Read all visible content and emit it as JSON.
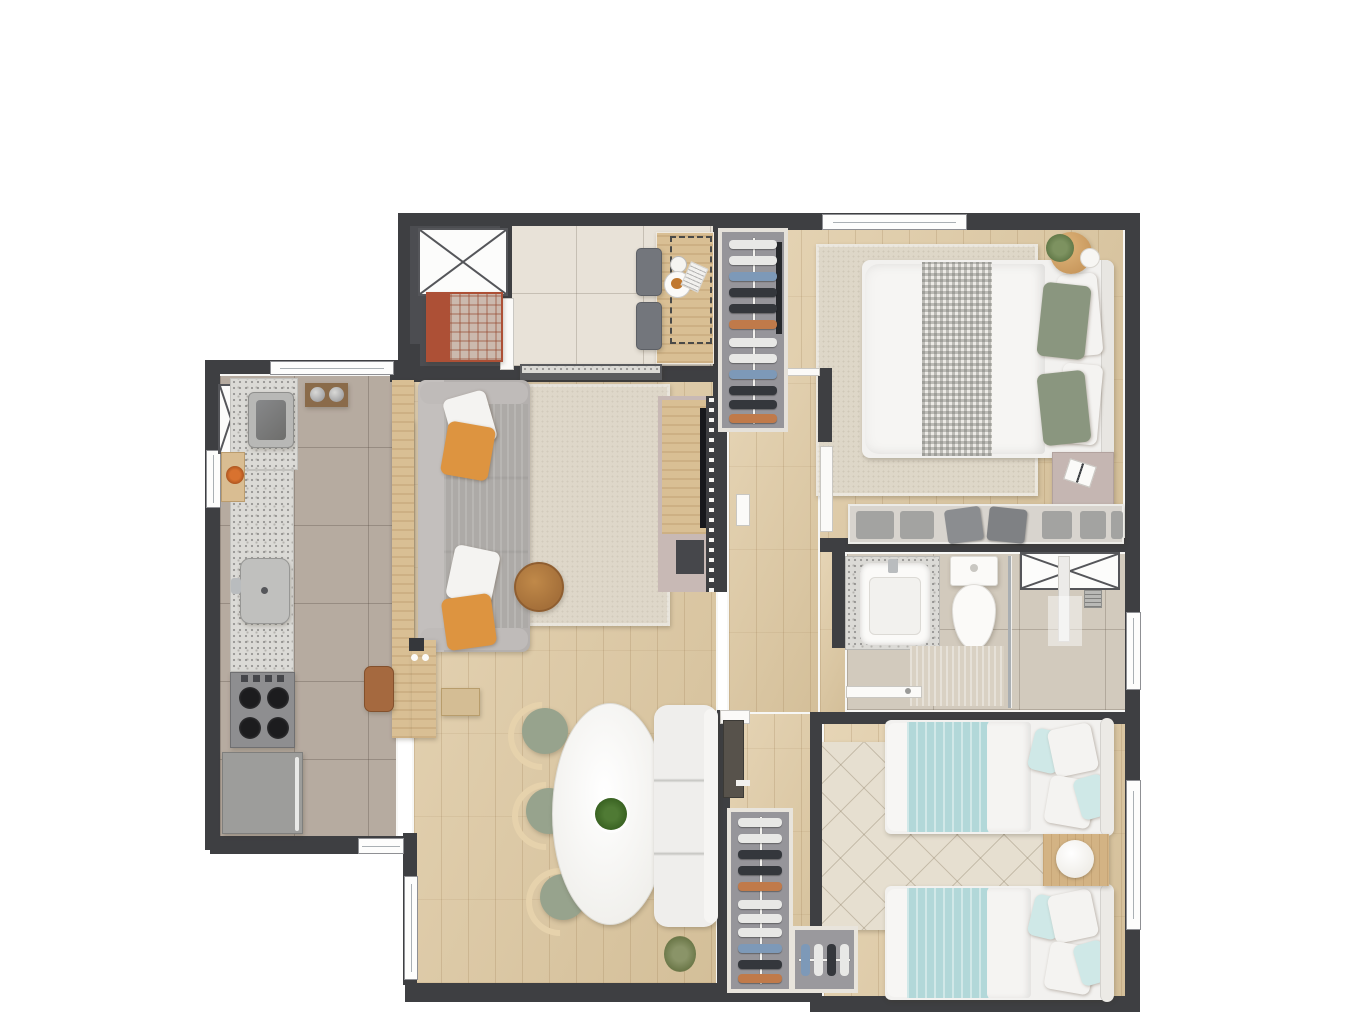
{
  "meta": {
    "title": "two-bedroom apartment floor plan (top-down 3D render)",
    "canvas": {
      "width": 1365,
      "height": 1024
    },
    "visible_text": "none"
  },
  "palette": {
    "background": "#ffffff",
    "wall": "#3e3f42",
    "wall_trim": "#f7f7f5",
    "wood_floor": "#dfc9a1",
    "entry_tile": "#e8e2d8",
    "kitchen_tile": "#b6aba0",
    "bath_tile": "#d2cabd",
    "granite": "#dbdad6",
    "sofa_gray": "#b4b0ae",
    "accent_orange": "#dd9440",
    "pillow_green": "#8a967f",
    "aqua_blanket": "#b2d8d9",
    "rug_cream": "#ded7c9",
    "rug_red": "#ad5036",
    "closet_gray": "#96959a",
    "furniture_wood": "#d9bf94",
    "dark_appliance": "#8e8e90"
  },
  "rooms": {
    "entry_hall": {
      "label": "hall and entry foyer",
      "items": [
        "elevator shaft",
        "red doormat rug with plaid throw",
        "console table",
        "dashed optional-furniture outline",
        "two gray side chairs",
        "breakfast tray with coffee and croissant"
      ]
    },
    "living_room": {
      "label": "living room",
      "items": [
        "gray chaise sofa",
        "orange and white throw pillows",
        "wood console with knobs",
        "round wood coffee table",
        "beige area rug",
        "TV wall panel with speaker",
        "granite-top sideboard",
        "slatted divider panel"
      ]
    },
    "kitchen": {
      "label": "kitchen and laundry",
      "items": [
        "laundry tank sink",
        "granite countertop",
        "stainless kitchen sink",
        "four-burner cooktop",
        "refrigerator",
        "breakfast bar peninsula",
        "bar stool",
        "duct shaft",
        "wall taps",
        "cutting board with flowers"
      ]
    },
    "dining_room": {
      "label": "dining area",
      "items": [
        "oval white marble table",
        "centerpiece plant",
        "three green wood-back chairs",
        "white upholstered bench",
        "floor plant"
      ]
    },
    "master_bedroom": {
      "label": "master bedroom",
      "items": [
        "double bed with white duvet and checked throw",
        "green pillows",
        "open wardrobe with hangers",
        "beige area rug",
        "plant side table",
        "nightstand with book",
        "low dresser with folded clothes",
        "window"
      ]
    },
    "bathroom": {
      "label": "bathroom",
      "items": [
        "granite vanity with vessel sink",
        "toilet",
        "bath mat",
        "glass shower partition",
        "shower column and drain",
        "duct shaft",
        "window",
        "door"
      ]
    },
    "second_bedroom": {
      "label": "second bedroom",
      "items": [
        "two single beds with aqua blankets",
        "shared wood nightstand with round lamp",
        "diamond-pattern cream rug",
        "corner wardrobe with hangers",
        "window"
      ]
    },
    "hallway": {
      "label": "bedroom hallway",
      "items": [
        "wood floor corridor",
        "doors to bedrooms and bathroom",
        "tall wardrobe with hangers and shoes"
      ]
    }
  }
}
